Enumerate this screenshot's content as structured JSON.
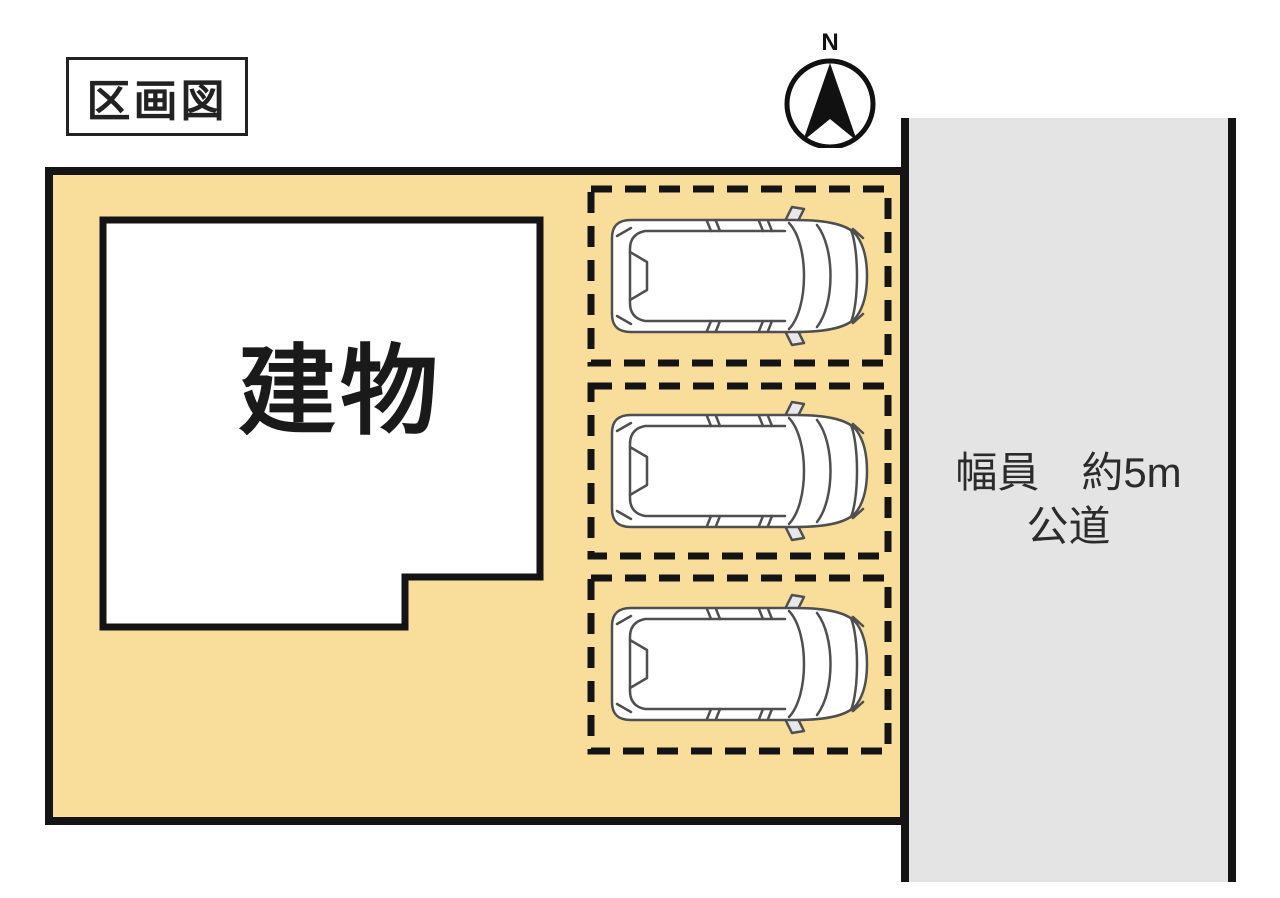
{
  "diagram": {
    "title": "区画図",
    "compass": {
      "north_label": "N"
    },
    "building": {
      "label": "建物"
    },
    "road": {
      "width_label": "幅員　約5m",
      "type_label": "公道"
    },
    "parking": {
      "space_count": 3
    }
  },
  "colors": {
    "plot_fill": "#f8dd9b",
    "road_fill": "#e4e4e4",
    "outline": "#141414",
    "building_fill": "#ffffff"
  }
}
